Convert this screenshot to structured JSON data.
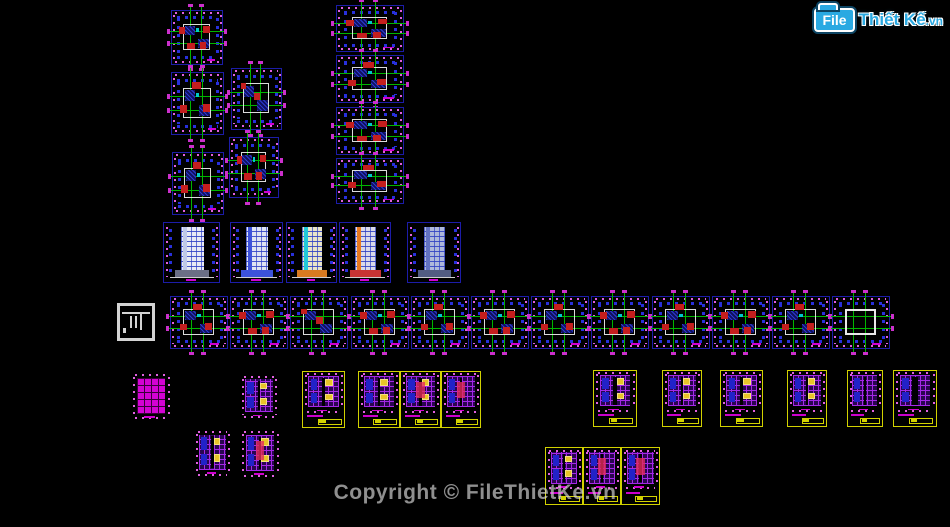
{
  "canvas": {
    "background": "#000000",
    "width": 950,
    "height": 527
  },
  "logo": {
    "file": "File",
    "thiet": "Thiết",
    "ke": "Kế",
    "vn": ".vn",
    "brand_color": "#2aa9e2"
  },
  "watermark": {
    "text": "Copyright © FileThietKe.vn",
    "color": "#8f8f8f"
  },
  "palette": {
    "sheet_border_blue": "#1c1ca8",
    "sheet_border_yellow": "#d2d200",
    "axis_green": "#00b400",
    "dimension_magenta": "#e060e0",
    "column_blue": "#2830dc",
    "wall_white": "#dcdcdc",
    "furniture_red": "#c41e1e",
    "hatch_blue": "#2a3ad0",
    "rebar_purple": "#a428e6",
    "patch_yellow": "#e8c428",
    "grid_magenta": "#d402d4"
  },
  "drawings": [
    {
      "name": "floor-plan-c1",
      "type": "floorplan",
      "x": 171,
      "y": 10,
      "w": 52,
      "h": 55,
      "v": 0
    },
    {
      "name": "floor-plan-c2",
      "type": "floorplan",
      "x": 171,
      "y": 72,
      "w": 53,
      "h": 63,
      "v": 1
    },
    {
      "name": "floor-plan-c3",
      "type": "floorplan",
      "x": 231,
      "y": 68,
      "w": 51,
      "h": 62,
      "v": 2
    },
    {
      "name": "floor-plan-c4",
      "type": "floorplan",
      "x": 172,
      "y": 152,
      "w": 52,
      "h": 63,
      "v": 1
    },
    {
      "name": "floor-plan-c5",
      "type": "floorplan",
      "x": 229,
      "y": 137,
      "w": 50,
      "h": 61,
      "v": 0
    },
    {
      "name": "floor-plan-t1",
      "type": "floorplan",
      "x": 336,
      "y": 5,
      "w": 68,
      "h": 47,
      "v": 0
    },
    {
      "name": "floor-plan-t2",
      "type": "floorplan",
      "x": 336,
      "y": 55,
      "w": 68,
      "h": 48,
      "v": 1
    },
    {
      "name": "floor-plan-t3",
      "type": "floorplan",
      "x": 336,
      "y": 107,
      "w": 68,
      "h": 48,
      "v": 0
    },
    {
      "name": "floor-plan-t4",
      "type": "floorplan",
      "x": 336,
      "y": 158,
      "w": 68,
      "h": 46,
      "v": 1
    },
    {
      "name": "elevation-1",
      "type": "elevation",
      "x": 163,
      "y": 222,
      "w": 57,
      "h": 61,
      "facade": "#e9ebf4",
      "accent": "#c0c9ea",
      "base": "#6b6f85"
    },
    {
      "name": "elevation-2",
      "type": "elevation",
      "x": 230,
      "y": 222,
      "w": 53,
      "h": 61,
      "facade": "#dfe4f2",
      "accent": "#3c52da",
      "base": "#3c52da"
    },
    {
      "name": "elevation-3",
      "type": "elevation",
      "x": 286,
      "y": 222,
      "w": 51,
      "h": 61,
      "facade": "#e9e5c9",
      "accent": "#22c9da",
      "base": "#d87a20"
    },
    {
      "name": "elevation-4",
      "type": "elevation",
      "x": 339,
      "y": 222,
      "w": 52,
      "h": 61,
      "facade": "#dadae9",
      "accent": "#e87a20",
      "base": "#c83434"
    },
    {
      "name": "elevation-5",
      "type": "elevation",
      "x": 407,
      "y": 222,
      "w": 54,
      "h": 61,
      "facade": "#aeb8da",
      "accent": "#6272c2",
      "base": "#525c82"
    },
    {
      "name": "legend-icon",
      "type": "whiteicon",
      "x": 117,
      "y": 303,
      "w": 38,
      "h": 38
    },
    {
      "name": "floor-plan-r1",
      "type": "floorplan",
      "x": 170,
      "y": 296,
      "w": 58,
      "h": 53,
      "v": 1
    },
    {
      "name": "floor-plan-r2",
      "type": "floorplan",
      "x": 230,
      "y": 296,
      "w": 58,
      "h": 53,
      "v": 0
    },
    {
      "name": "floor-plan-r3",
      "type": "floorplan",
      "x": 290,
      "y": 296,
      "w": 58,
      "h": 53,
      "v": 2
    },
    {
      "name": "floor-plan-r4",
      "type": "floorplan",
      "x": 351,
      "y": 296,
      "w": 58,
      "h": 53,
      "v": 0
    },
    {
      "name": "floor-plan-r5",
      "type": "floorplan",
      "x": 411,
      "y": 296,
      "w": 58,
      "h": 53,
      "v": 1
    },
    {
      "name": "floor-plan-r6",
      "type": "floorplan",
      "x": 471,
      "y": 296,
      "w": 58,
      "h": 53,
      "v": 0
    },
    {
      "name": "floor-plan-r7",
      "type": "floorplan",
      "x": 531,
      "y": 296,
      "w": 58,
      "h": 53,
      "v": 1
    },
    {
      "name": "floor-plan-r8",
      "type": "floorplan",
      "x": 591,
      "y": 296,
      "w": 58,
      "h": 53,
      "v": 0
    },
    {
      "name": "floor-plan-r9",
      "type": "floorplan",
      "x": 652,
      "y": 296,
      "w": 58,
      "h": 53,
      "v": 1
    },
    {
      "name": "floor-plan-r10",
      "type": "floorplan",
      "x": 712,
      "y": 296,
      "w": 58,
      "h": 53,
      "v": 0
    },
    {
      "name": "floor-plan-r11",
      "type": "floorplan",
      "x": 772,
      "y": 296,
      "w": 58,
      "h": 53,
      "v": 1
    },
    {
      "name": "floor-plan-r12",
      "type": "floorplan",
      "x": 832,
      "y": 296,
      "w": 58,
      "h": 53,
      "v": 3
    },
    {
      "name": "grid-plan",
      "type": "gridplan",
      "x": 133,
      "y": 374,
      "w": 36,
      "h": 45
    },
    {
      "name": "framing-plan-1",
      "type": "purpleplan",
      "x": 242,
      "y": 376,
      "w": 34,
      "h": 42,
      "patch": true
    },
    {
      "name": "framing-plan-2",
      "type": "purpleplan",
      "x": 196,
      "y": 431,
      "w": 33,
      "h": 45,
      "patch": true
    },
    {
      "name": "framing-plan-3",
      "type": "purpleplan",
      "x": 242,
      "y": 431,
      "w": 36,
      "h": 46,
      "patch": true,
      "hot": true
    },
    {
      "name": "detail-sheet-1",
      "type": "yellowbox",
      "x": 302,
      "y": 371,
      "w": 43,
      "h": 57,
      "patch": true
    },
    {
      "name": "detail-sheet-2",
      "type": "yellowbox",
      "x": 358,
      "y": 371,
      "w": 42,
      "h": 57,
      "patch": true
    },
    {
      "name": "detail-sheet-3",
      "type": "yellowbox",
      "x": 400,
      "y": 371,
      "w": 41,
      "h": 57,
      "patch": true,
      "hot": true
    },
    {
      "name": "detail-sheet-4",
      "type": "yellowbox",
      "x": 441,
      "y": 371,
      "w": 40,
      "h": 57,
      "hot": true
    },
    {
      "name": "detail-sheet-5",
      "type": "yellowbox",
      "x": 593,
      "y": 370,
      "w": 44,
      "h": 57,
      "patch": true
    },
    {
      "name": "detail-sheet-6",
      "type": "yellowbox",
      "x": 662,
      "y": 370,
      "w": 40,
      "h": 57,
      "patch": true
    },
    {
      "name": "detail-sheet-7",
      "type": "yellowbox",
      "x": 720,
      "y": 370,
      "w": 43,
      "h": 57,
      "patch": true
    },
    {
      "name": "detail-sheet-8",
      "type": "yellowbox",
      "x": 787,
      "y": 370,
      "w": 40,
      "h": 57,
      "patch": true
    },
    {
      "name": "detail-sheet-9",
      "type": "yellowbox",
      "x": 847,
      "y": 370,
      "w": 36,
      "h": 57
    },
    {
      "name": "detail-sheet-10",
      "type": "yellowbox",
      "x": 893,
      "y": 370,
      "w": 44,
      "h": 57,
      "split": true
    },
    {
      "name": "detail-sheet-11",
      "type": "yellowbox",
      "x": 545,
      "y": 447,
      "w": 38,
      "h": 58,
      "patch": true
    },
    {
      "name": "detail-sheet-12",
      "type": "yellowbox",
      "x": 583,
      "y": 447,
      "w": 38,
      "h": 58,
      "hot": true
    },
    {
      "name": "detail-sheet-13",
      "type": "yellowbox",
      "x": 621,
      "y": 447,
      "w": 39,
      "h": 58,
      "hot": true
    }
  ]
}
